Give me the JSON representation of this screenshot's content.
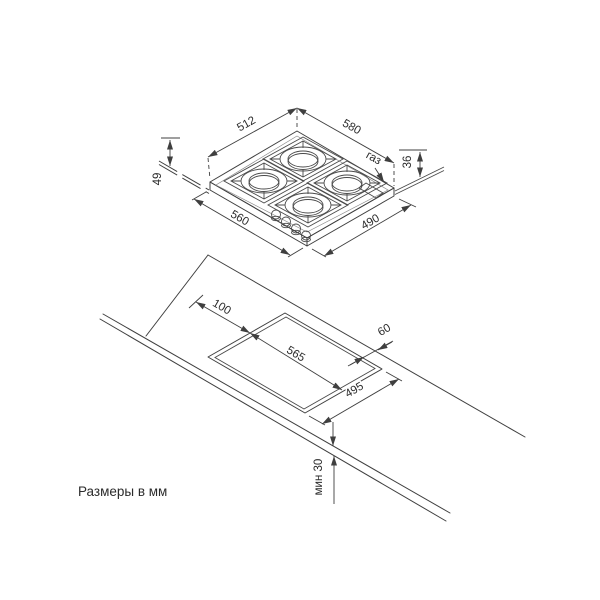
{
  "diagram": {
    "note": "Размеры в мм",
    "hob": {
      "dim_top_width": "512",
      "dim_total_width": "580",
      "dim_height_above_counter": "36",
      "dim_total_height": "49",
      "dim_depth_left": "560",
      "dim_depth_right": "490",
      "gas_label": "газ"
    },
    "counter": {
      "dim_back_clearance": "100",
      "dim_right_clearance": "60",
      "dim_cutout_length": "565",
      "dim_cutout_width": "495",
      "dim_min_thickness": "мин 30"
    }
  }
}
